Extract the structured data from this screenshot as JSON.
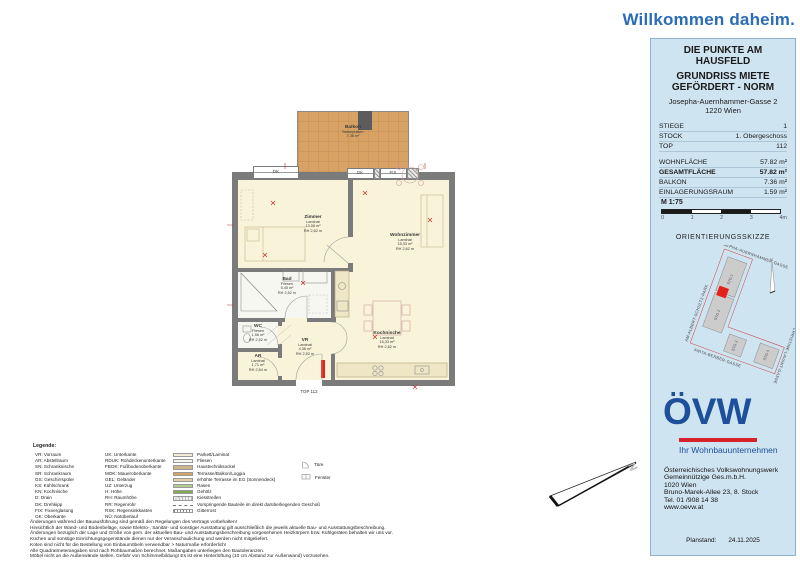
{
  "colors": {
    "accent-blue": "#2b6cb8",
    "logo-blue": "#1d4f9b",
    "logo-red": "#d5222b",
    "panel-bg": "#cfe4f1",
    "wall": "#7b7b7b",
    "floor-laminat": "#f8f3d9",
    "floor-fliesen": "#f7f7f2",
    "balcony": "#d7a263",
    "dim-red": "#cc2222",
    "marker-red": "#e32219"
  },
  "header": {
    "welcome": "Willkommen daheim."
  },
  "panel": {
    "title1": "DIE PUNKTE AM HAUSFELD",
    "title2": "GRUNDRISS MIETE GEFÖRDERT - NORM",
    "address1": "Josepha-Auernhammer-Gasse 2",
    "address2": "1220 Wien",
    "info_rows": [
      {
        "label": "STIEGE",
        "value": "1"
      },
      {
        "label": "STOCK",
        "value": "1. Obergeschoss"
      },
      {
        "label": "TOP",
        "value": "112"
      }
    ],
    "area_rows": [
      {
        "label": "WOHNFLÄCHE",
        "value": "57.82 m²"
      },
      {
        "label": "GESAMTFLÄCHE",
        "value": "57.82 m²"
      },
      {
        "label": "BALKON",
        "value": "7.36 m²"
      },
      {
        "label": "EINLAGERUNGSRAUM",
        "value": "1.59 m²"
      }
    ],
    "scale_label": "M 1:75",
    "scale_ticks": [
      "0",
      "1",
      "2",
      "3",
      "4m"
    ],
    "orientation_title": "ORIENTIERUNGSSKIZZE",
    "sketch": {
      "streets": {
        "top": "JOSEPHA-AUERNHAMMER-GASSE",
        "left": "AM-ALBERT-SCHULTZ-PARK",
        "bottom": "ANITA-BERBER-GASSE",
        "right": "CHRISTINE-LAVANT-GASSE"
      },
      "buildings": [
        "STG 1",
        "STG 2",
        "STG 3",
        "STG 4"
      ],
      "north": "N"
    },
    "logo": {
      "name": "ÖVW",
      "tagline": "Ihr Wohnbauunternehmen"
    },
    "company": [
      "Österreichisches Volkswohnungswerk",
      "Gemeinnützige Ges.m.b.H.",
      "1020 Wien",
      "Bruno-Marek-Allee 23, 8. Stock",
      "Tel. 01 /908 14 38",
      "www.oevw.at"
    ],
    "planstand_label": "Planstand:",
    "planstand_value": "24.11.2025"
  },
  "plan": {
    "rooms": [
      {
        "name": "Balkon",
        "material": "Betonplatten",
        "area": "7,36 m²",
        "rh": ""
      },
      {
        "name": "Zimmer",
        "material": "Laminat",
        "area": "13,08 m²",
        "rh": "RH 2,62 m"
      },
      {
        "name": "Wohnzimmer",
        "material": "Laminat",
        "area": "15,33 m²",
        "rh": "RH 2,62 m"
      },
      {
        "name": "Kochnische",
        "material": "Laminat",
        "area": "16,33 m²",
        "rh": "RH 2,62 m"
      },
      {
        "name": "Bad",
        "material": "Fliesen",
        "area": "5,45 m²",
        "rh": "RH 2,52 m"
      },
      {
        "name": "WC",
        "material": "Fliesen",
        "area": "1,56 m²",
        "rh": "RH 2,52 m"
      },
      {
        "name": "VR",
        "material": "Laminat",
        "area": "4,36 m²",
        "rh": "RH 2,52 m"
      },
      {
        "name": "AR",
        "material": "Laminat",
        "area": "1,71 m²",
        "rh": "RH 2,54 m"
      }
    ],
    "windows": [
      {
        "label": "DK"
      },
      {
        "label": "DK"
      },
      {
        "label": "FIX"
      }
    ],
    "entrance_label": "TOP 112",
    "north": "N"
  },
  "legend": {
    "title": "Legende:",
    "col1": [
      "VR: Vorraum",
      "AR: Abstellraum",
      "SN: Schranknische",
      "SR: Schrankraum",
      "GS: Geschirrspüler",
      "KS: Kühlschrank",
      "KN: Kochnische",
      "D: Drain",
      "DK: Drehkipp",
      "FIX: Fixverglasung",
      "OK: Oberkante"
    ],
    "col2": [
      "UK: Unterkante",
      "RDUK: Rohdeckenunterkante",
      "FBOK: Fußbodenoberkante",
      "MOK: Maueroberkante",
      "GEL: Geländer",
      "UZ: Unterzug",
      "H: Höhe",
      "RH: Raumhöhe",
      "RR: Regenrohr",
      "RSK: Regensinkkasten",
      "NÜ: Notüberlauf"
    ],
    "swatches": [
      {
        "label": "Parkett/Laminat",
        "color": "#f2ecd2",
        "type": "fill"
      },
      {
        "label": "Fliesen",
        "color": "#f7f7f2",
        "type": "fill"
      },
      {
        "label": "Haustechniksockel",
        "color": "#c9b689",
        "type": "fill"
      },
      {
        "label": "Terrasse/Balkon/Loggia",
        "color": "#d7a263",
        "type": "fill"
      },
      {
        "label": "erhöhte Terrasse im EG (Sonnendeck)",
        "color": "#e3cf9f",
        "type": "fill"
      },
      {
        "label": "Rasen",
        "color": "#b5cc8e",
        "type": "fill"
      },
      {
        "label": "Gehölz",
        "color": "#85a854",
        "type": "fill"
      },
      {
        "label": "Kiesstreifen",
        "color": "#d8d8d8",
        "type": "dots"
      },
      {
        "label": "Vorspringende Bauteile im direkt darüberliegenden Geschoß",
        "type": "dash"
      },
      {
        "label": "Gitterrost",
        "type": "hatch"
      }
    ],
    "symbols": [
      {
        "label": "Türe"
      },
      {
        "label": "Fenster"
      }
    ]
  },
  "footnotes": [
    "Änderungen während der Bauausführung sind gemäß den Regelungen des Vertrags vorbehalten!",
    "Hinsichtlich der Wand- und Bodenbeläge, sowie Elektro-, Sanitär- und sonstiger Ausstattung gilt ausschließlich die jeweils aktuelle Bau- und Ausstattungsbeschreibung.",
    "Änderungen bezüglich der Lage und Größe von gem. der aktuellen Bau- und Ausstattungsbeschreibung vorgesehenen Heizkörpern bzw. Kühlgeräten behalten wir uns vor.",
    "Küchen und sonstige Einrichtungsgegenstände dienen nur der Veranschaulichung und werden nicht mitgeliefert.",
    "Koten sind nicht für die Bestellung von Einbaumöbeln verwendbar > Naturmaße erforderlich!",
    "Alle Quadratmeterangaben sind nach Rohbaumaßen berechnet. Maßangaben unterliegen den Bautoleranzen.",
    "Möbel nicht an die Außenwände stellen. Gefahr von Schimmelbildung! Es ist eine Hinterlüftung (10 cm Abstand zur Außenwand) vorzusehen."
  ]
}
